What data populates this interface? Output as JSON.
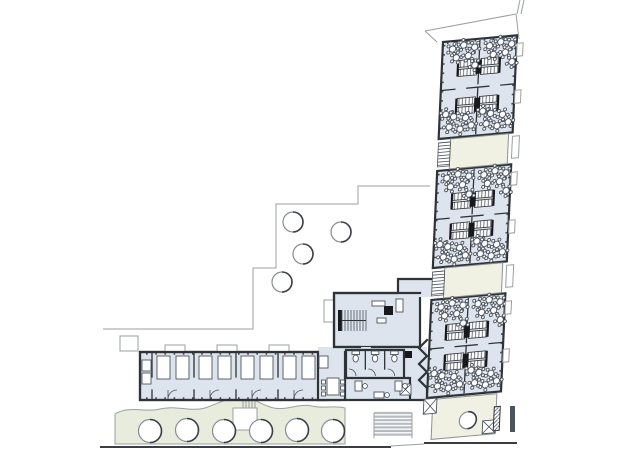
{
  "meta": {
    "title": "Architectural floor plan",
    "description": "Ground-floor plan: diagonal classroom wing with six classroom clusters, terraces, central core with stair, WCs and office, cloakroom wing, garden band with trees"
  },
  "colors": {
    "paper": "#ffffff",
    "room_fill": "#dde4ed",
    "terrace_fill": "#f0f1e2",
    "landscape_fill": "#e7ecdc",
    "wall": "#2f3338",
    "wall_black": "#17191c",
    "furniture": "#4c545e",
    "site_line": "#9aa09c",
    "step_gray": "#b6bcc2"
  },
  "site": {
    "courtyard_trees": [
      {
        "x": 293,
        "y": 222
      },
      {
        "x": 341,
        "y": 232
      },
      {
        "x": 303,
        "y": 254
      },
      {
        "x": 282,
        "y": 282
      }
    ],
    "courtyard_tree_r": 10,
    "garden_trees": [
      {
        "x": 150,
        "y": 431
      },
      {
        "x": 187,
        "y": 430
      },
      {
        "x": 224,
        "y": 431
      },
      {
        "x": 261,
        "y": 431
      },
      {
        "x": 297,
        "y": 430
      },
      {
        "x": 333,
        "y": 431
      }
    ],
    "garden_tree_r": 11.5,
    "ext_stair": {
      "x": 374,
      "y": 413,
      "w": 38,
      "treads": 7,
      "gap": 3.6
    }
  },
  "wing": {
    "transform": "matrix(1,-0.09,-0.045,1,443,42)",
    "width": 74,
    "center_u": 37,
    "pair_bounds": [
      [
        0,
        97
      ],
      [
        129,
        226
      ],
      [
        258,
        356
      ]
    ],
    "clusters": [
      {
        "v": 0,
        "h": 47,
        "storage_v": 20,
        "flowers": "top"
      },
      {
        "v": 47,
        "h": 50,
        "storage_v": 58,
        "flowers": "bottom"
      },
      {
        "v": 129,
        "h": 48,
        "storage_v": 153,
        "flowers": "top"
      },
      {
        "v": 177,
        "h": 49,
        "storage_v": 183,
        "flowers": "bottom"
      },
      {
        "v": 258,
        "h": 48,
        "storage_v": 284,
        "flowers": "top"
      },
      {
        "v": 306,
        "h": 50,
        "storage_v": 314,
        "flowers": "bottom"
      }
    ],
    "flower_sets": {
      "top": [
        [
          8,
          8
        ],
        [
          19,
          5
        ],
        [
          30,
          8
        ],
        [
          12,
          17
        ],
        [
          24,
          16
        ],
        [
          31,
          26
        ]
      ],
      "bottom": [
        [
          8,
          39
        ],
        [
          19,
          42
        ],
        [
          30,
          39
        ],
        [
          12,
          29
        ],
        [
          24,
          31
        ],
        [
          4,
          26
        ]
      ]
    },
    "room_offsets": [
      2,
      39
    ],
    "table": {
      "r": 3.1,
      "chair_r": 1.5,
      "ring": 5.2,
      "chairs": 5
    },
    "terraces": [
      {
        "v": 97,
        "h": 32
      },
      {
        "v": 226,
        "h": 32
      }
    ],
    "terrace3": {
      "v": 356,
      "h": 42,
      "tree": {
        "u": 42,
        "v": 382,
        "r": 8.5
      }
    },
    "right_tabs_v": [
      8,
      55,
      137,
      185,
      266,
      314
    ]
  },
  "bottom_wing": {
    "bays_x": [
      152,
      194,
      236,
      278
    ],
    "bay_w": 42,
    "porches_x": [
      165,
      217,
      269
    ]
  },
  "junction": {
    "toilets": {
      "x": 346,
      "y": 350,
      "w": 58,
      "h": 26,
      "count": 3
    },
    "stair": {
      "x": 342,
      "y": 310,
      "w": 24,
      "h": 21,
      "treads": 8
    },
    "dining": {
      "x": 327,
      "y": 378,
      "w": 12,
      "h": 17,
      "chairs_per_side": 3
    },
    "office_desks": [
      [
        355,
        381,
        7,
        10
      ],
      [
        374,
        392,
        10,
        6
      ],
      [
        395,
        381,
        7,
        10
      ]
    ]
  }
}
